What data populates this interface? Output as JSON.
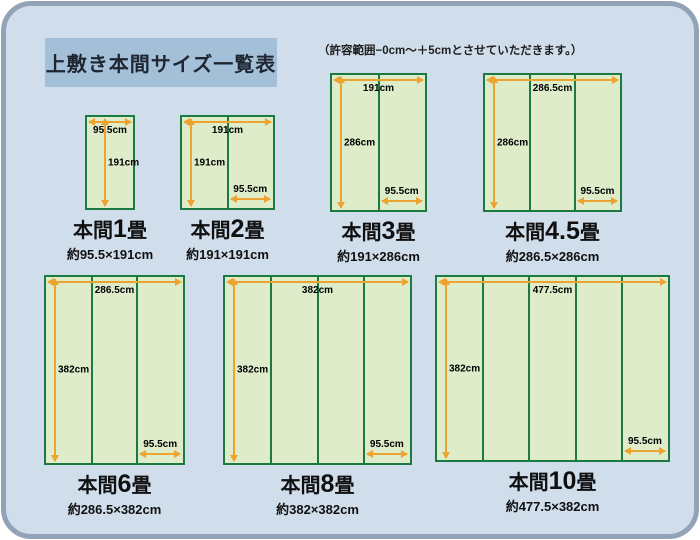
{
  "header": {
    "title": "上敷き本間サイズ一覧表",
    "note": "（許容範囲−0cm〜＋5cmとさせていただきます。）"
  },
  "colors": {
    "panel_fill": "#d0deec",
    "panel_border": "#92a3b8",
    "banner_bg": "#a3c0d8",
    "mat_fill": "#deecca",
    "mat_border": "#1a7a42",
    "arrow": "#eda32f"
  },
  "diagrams": [
    {
      "title_prefix": "本間",
      "size": "1",
      "title_suffix": "畳",
      "subtitle": "約95.5×191cm",
      "width_label": "95.5cm",
      "height_label": "191cm",
      "mat_width_label": "",
      "columns": 1
    },
    {
      "title_prefix": "本間",
      "size": "2",
      "title_suffix": "畳",
      "subtitle": "約191×191cm",
      "width_label": "191cm",
      "height_label": "191cm",
      "mat_width_label": "95.5cm",
      "columns": 2
    },
    {
      "title_prefix": "本間",
      "size": "3",
      "title_suffix": "畳",
      "subtitle": "約191×286cm",
      "width_label": "191cm",
      "height_label": "286cm",
      "mat_width_label": "95.5cm",
      "columns": 2
    },
    {
      "title_prefix": "本間",
      "size": "4.5",
      "title_suffix": "畳",
      "subtitle": "約286.5×286cm",
      "width_label": "286.5cm",
      "height_label": "286cm",
      "mat_width_label": "95.5cm",
      "columns": 3
    },
    {
      "title_prefix": "本間",
      "size": "6",
      "title_suffix": "畳",
      "subtitle": "約286.5×382cm",
      "width_label": "286.5cm",
      "height_label": "382cm",
      "mat_width_label": "95.5cm",
      "columns": 3
    },
    {
      "title_prefix": "本間",
      "size": "8",
      "title_suffix": "畳",
      "subtitle": "約382×382cm",
      "width_label": "382cm",
      "height_label": "382cm",
      "mat_width_label": "95.5cm",
      "columns": 4
    },
    {
      "title_prefix": "本間",
      "size": "10",
      "title_suffix": "畳",
      "subtitle": "約477.5×382cm",
      "width_label": "477.5cm",
      "height_label": "382cm",
      "mat_width_label": "95.5cm",
      "columns": 5
    }
  ]
}
